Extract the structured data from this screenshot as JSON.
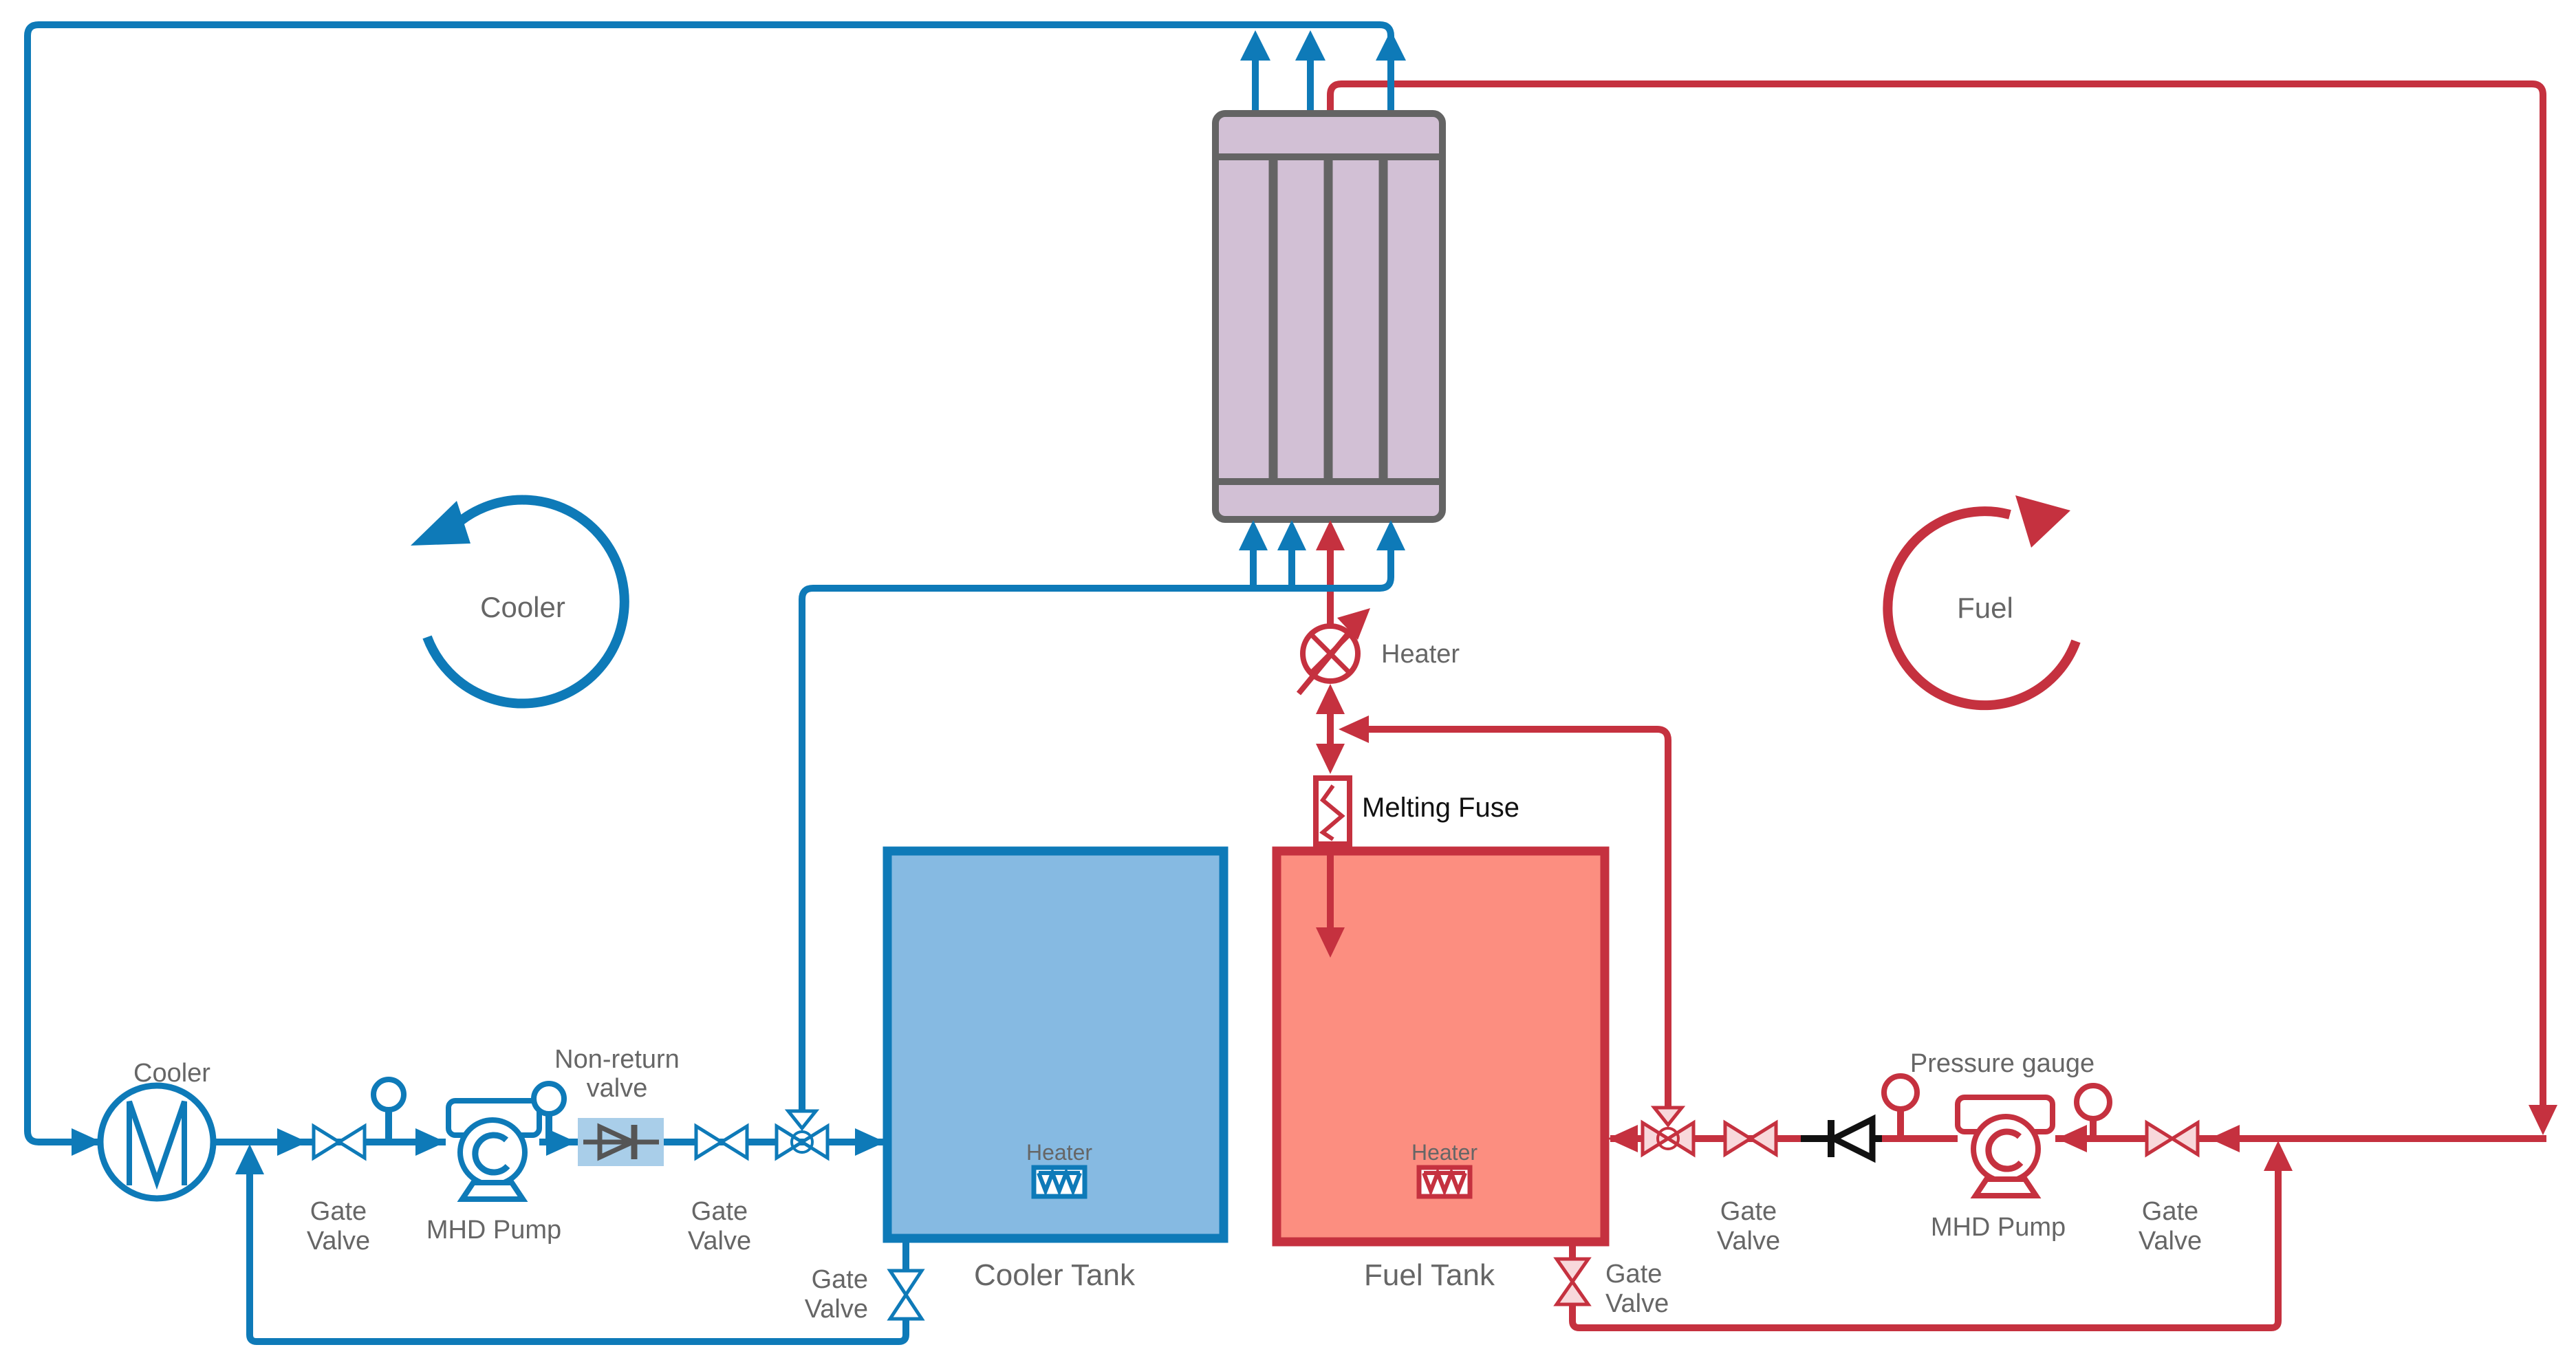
{
  "colors": {
    "cooler_blue": "#0E7AB8",
    "cooler_tank_fill": "#86BAE2",
    "fuel_red": "#C5313F",
    "fuel_tank_fill": "#FC8E80",
    "exchanger_fill": "#D2C0D5",
    "exchanger_border": "#646464",
    "label_gray": "#666666",
    "dark_text": "#111111",
    "nrv_fill": "#A9CEE9",
    "valve_pink_fill": "#F8D8DB",
    "check_valve_black": "#111111",
    "background": "#FFFFFF"
  },
  "loops": {
    "cooler_label": "Cooler",
    "fuel_label": "Fuel"
  },
  "labels": {
    "cooler_unit": "Cooler",
    "mhd_pump": "MHD Pump",
    "gate_valve_line1": "Gate",
    "gate_valve_line2": "Valve",
    "non_return_line1": "Non-return",
    "non_return_line2": "valve",
    "pressure_gauge": "Pressure gauge",
    "heater": "Heater",
    "tank_heater": "Heater",
    "melting_fuse": "Melting Fuse",
    "cooler_tank": "Cooler Tank",
    "fuel_tank": "Fuel Tank"
  }
}
